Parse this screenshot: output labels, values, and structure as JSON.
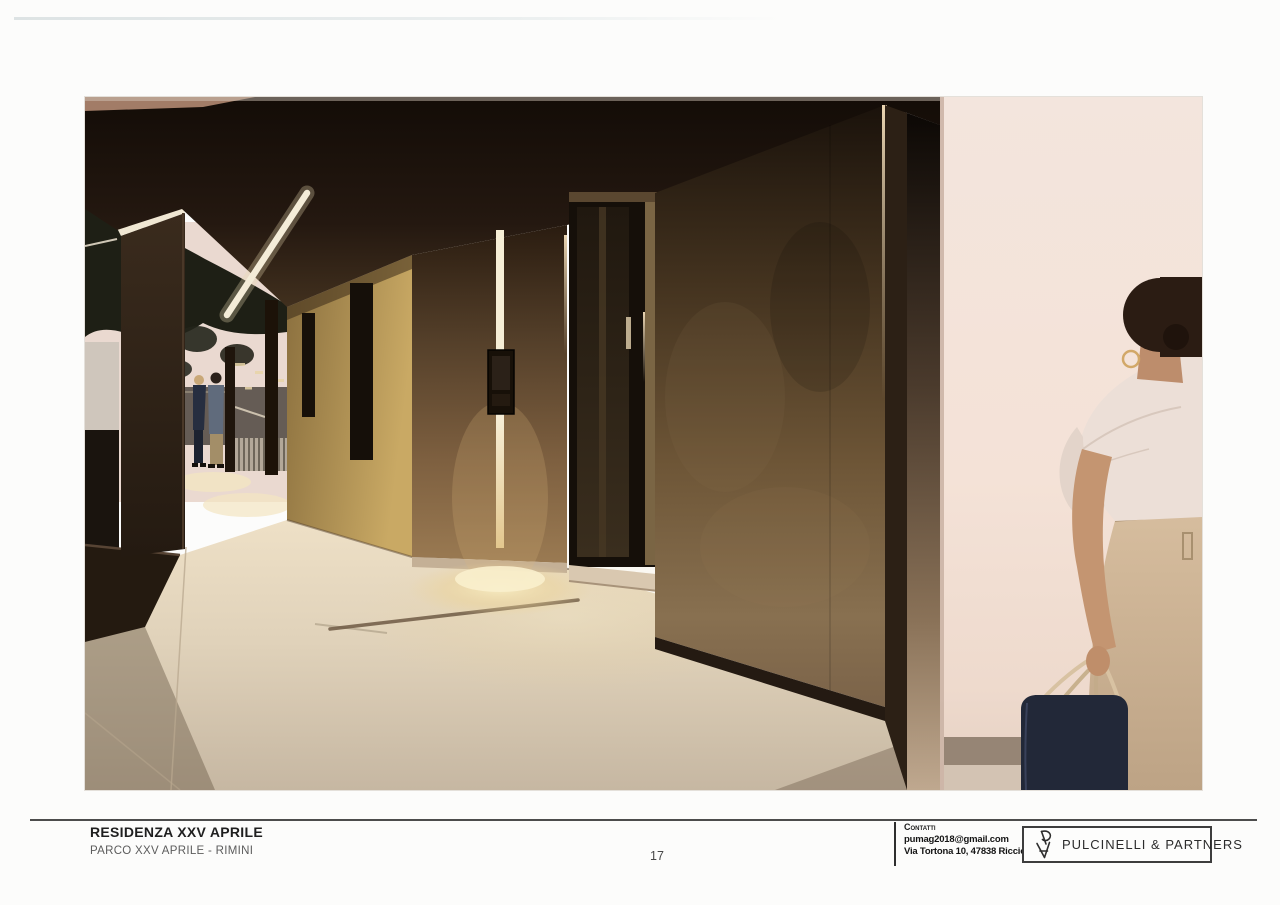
{
  "page": {
    "number": "17"
  },
  "footer": {
    "project_title": "RESIDENZA XXV APRILE",
    "project_subtitle": "PARCO XXV APRILE - RIMINI",
    "contact": {
      "heading": "Contatti",
      "email": "pumag2018@gmail.com",
      "address": "Via Tortona 10, 47838 Riccione"
    },
    "logo": {
      "name": "PULCINELLI & PARTNERS",
      "monogram_icon": "pulcinelli-monogram"
    }
  },
  "image": {
    "alt": "Evening rendering of the residence entrance walkway: dark soffit with linear lights, concrete pillars with a vertical light strip and intercom, glass entry door, large concrete panel, and a woman in a cream dress carrying a navy bag beside a pink-white wall; two people stand by a railing in the background",
    "palette": {
      "ceiling_dark": "#2a1d12",
      "concrete_panel": "#6e5637",
      "lit_wall_tan": "#c9a964",
      "floor_concrete": "#ddcfb8",
      "accent_light_warm": "#f6eed6",
      "white_wall_pink": "#f3e3d9",
      "sky_pink": "#ead9d0",
      "bag_navy": "#232838",
      "dress_cream": "#ecdfd7",
      "skirt_beige": "#cdb499"
    }
  }
}
